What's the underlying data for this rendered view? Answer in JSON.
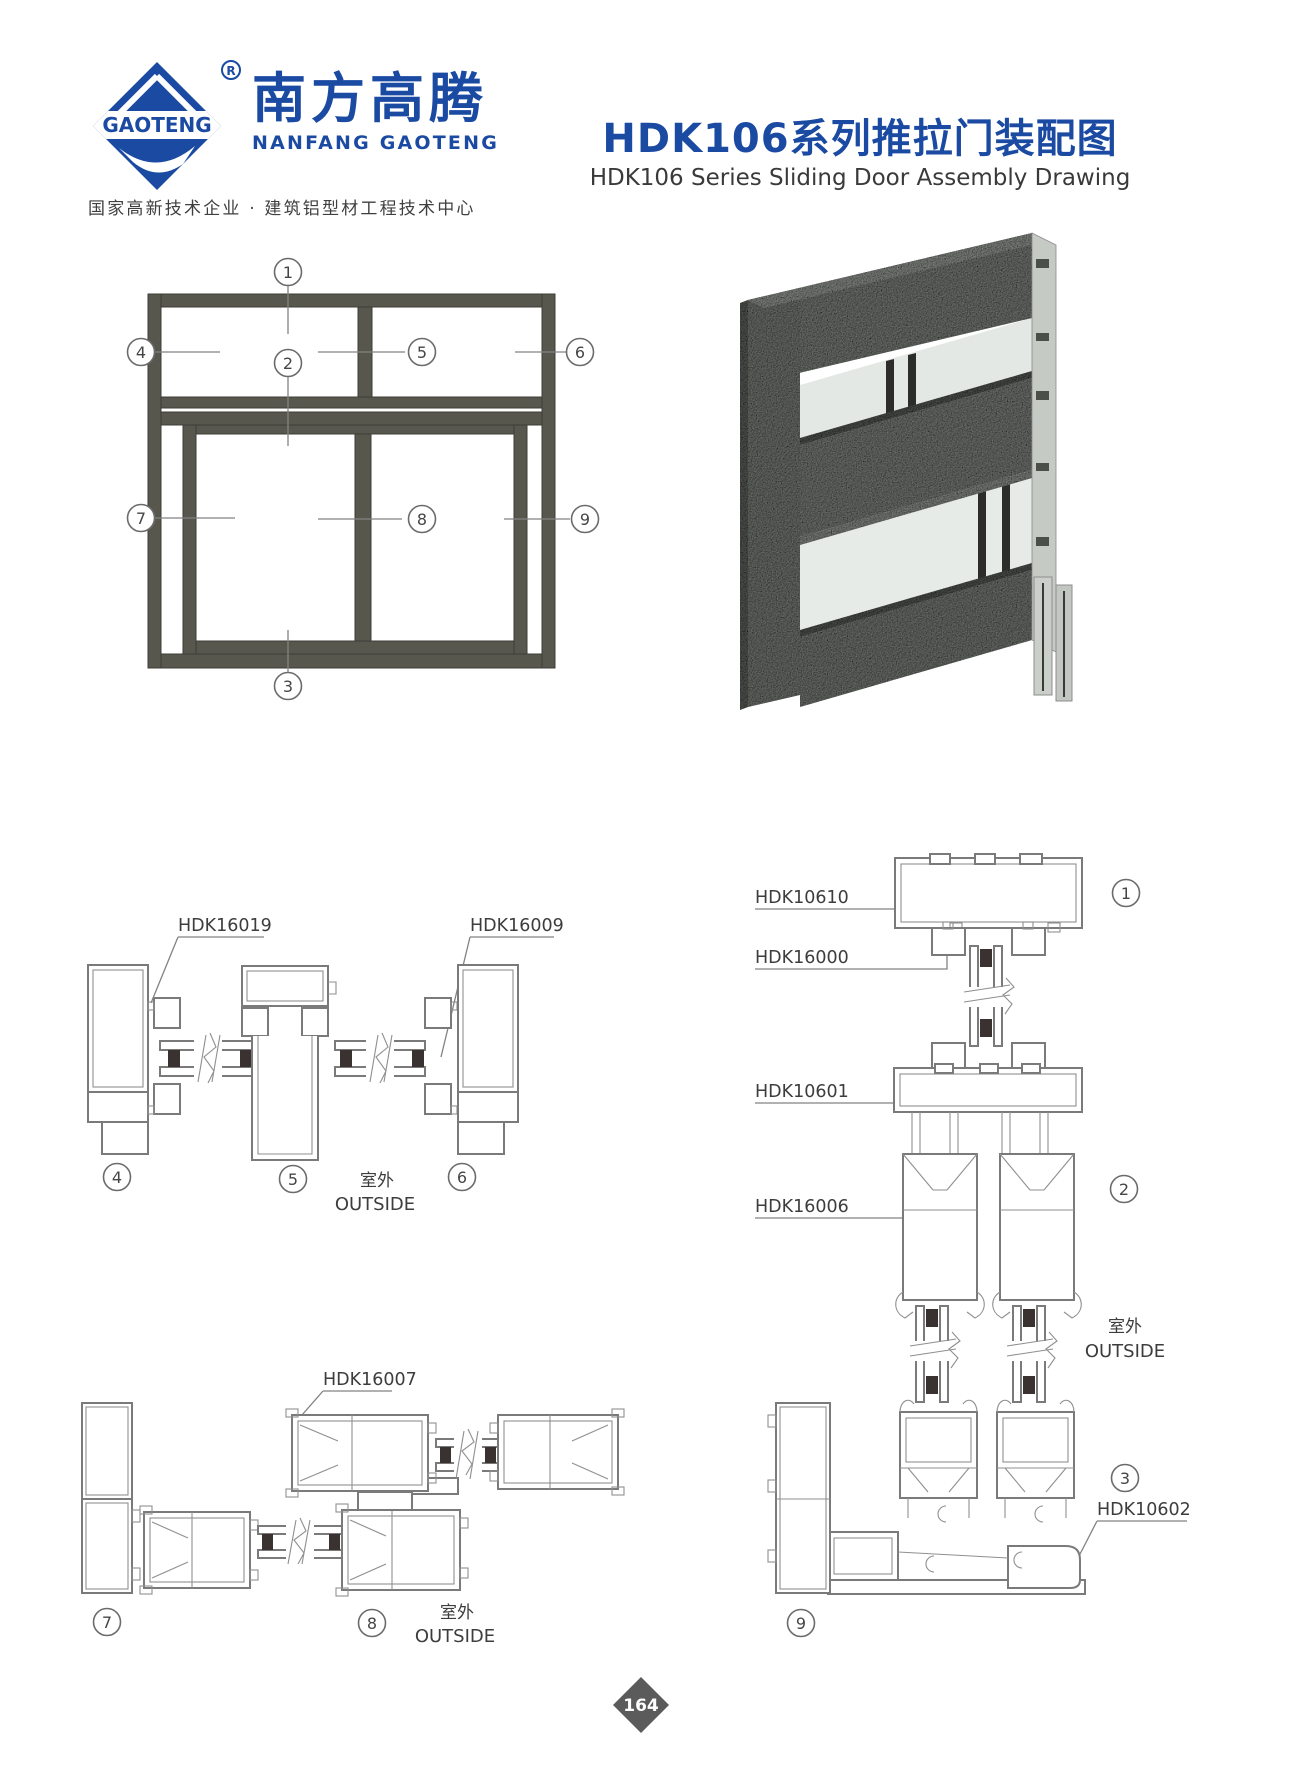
{
  "header": {
    "logo": {
      "mark": "GAOTENG",
      "registered": "R",
      "name_cn": "南方高腾",
      "name_en": "NANFANG GAOTENG",
      "tagline": "国家高新技术企业 · 建筑铝型材工程技术中心",
      "brand_color": "#1b4aa3"
    },
    "title_cn": "HDK106系列推拉门装配图",
    "title_en": "HDK106 Series Sliding Door Assembly Drawing"
  },
  "elevation": {
    "callouts": {
      "c1": "1",
      "c2": "2",
      "c3": "3",
      "c4": "4",
      "c5": "5",
      "c6": "6",
      "c7": "7",
      "c8": "8",
      "c9": "9"
    }
  },
  "section_mullion": {
    "label_left": "HDK16019",
    "label_right": "HDK16009",
    "callout_4": "4",
    "callout_5": "5",
    "callout_6": "6",
    "outside_cn": "室外",
    "outside_en": "OUTSIDE"
  },
  "section_sill_run": {
    "label_top": "HDK16007",
    "callout_7": "7",
    "callout_8": "8",
    "callout_9": "9",
    "outside_cn": "室外",
    "outside_en": "OUTSIDE"
  },
  "section_vertical": {
    "labels": {
      "head": "HDK10610",
      "sash_top": "HDK16000",
      "transom": "HDK10601",
      "track": "HDK16006",
      "sill": "HDK10602"
    },
    "callout_1": "1",
    "callout_2": "2",
    "callout_3": "3",
    "outside_cn": "室外",
    "outside_en": "OUTSIDE"
  },
  "footer": {
    "page_number": "164"
  }
}
